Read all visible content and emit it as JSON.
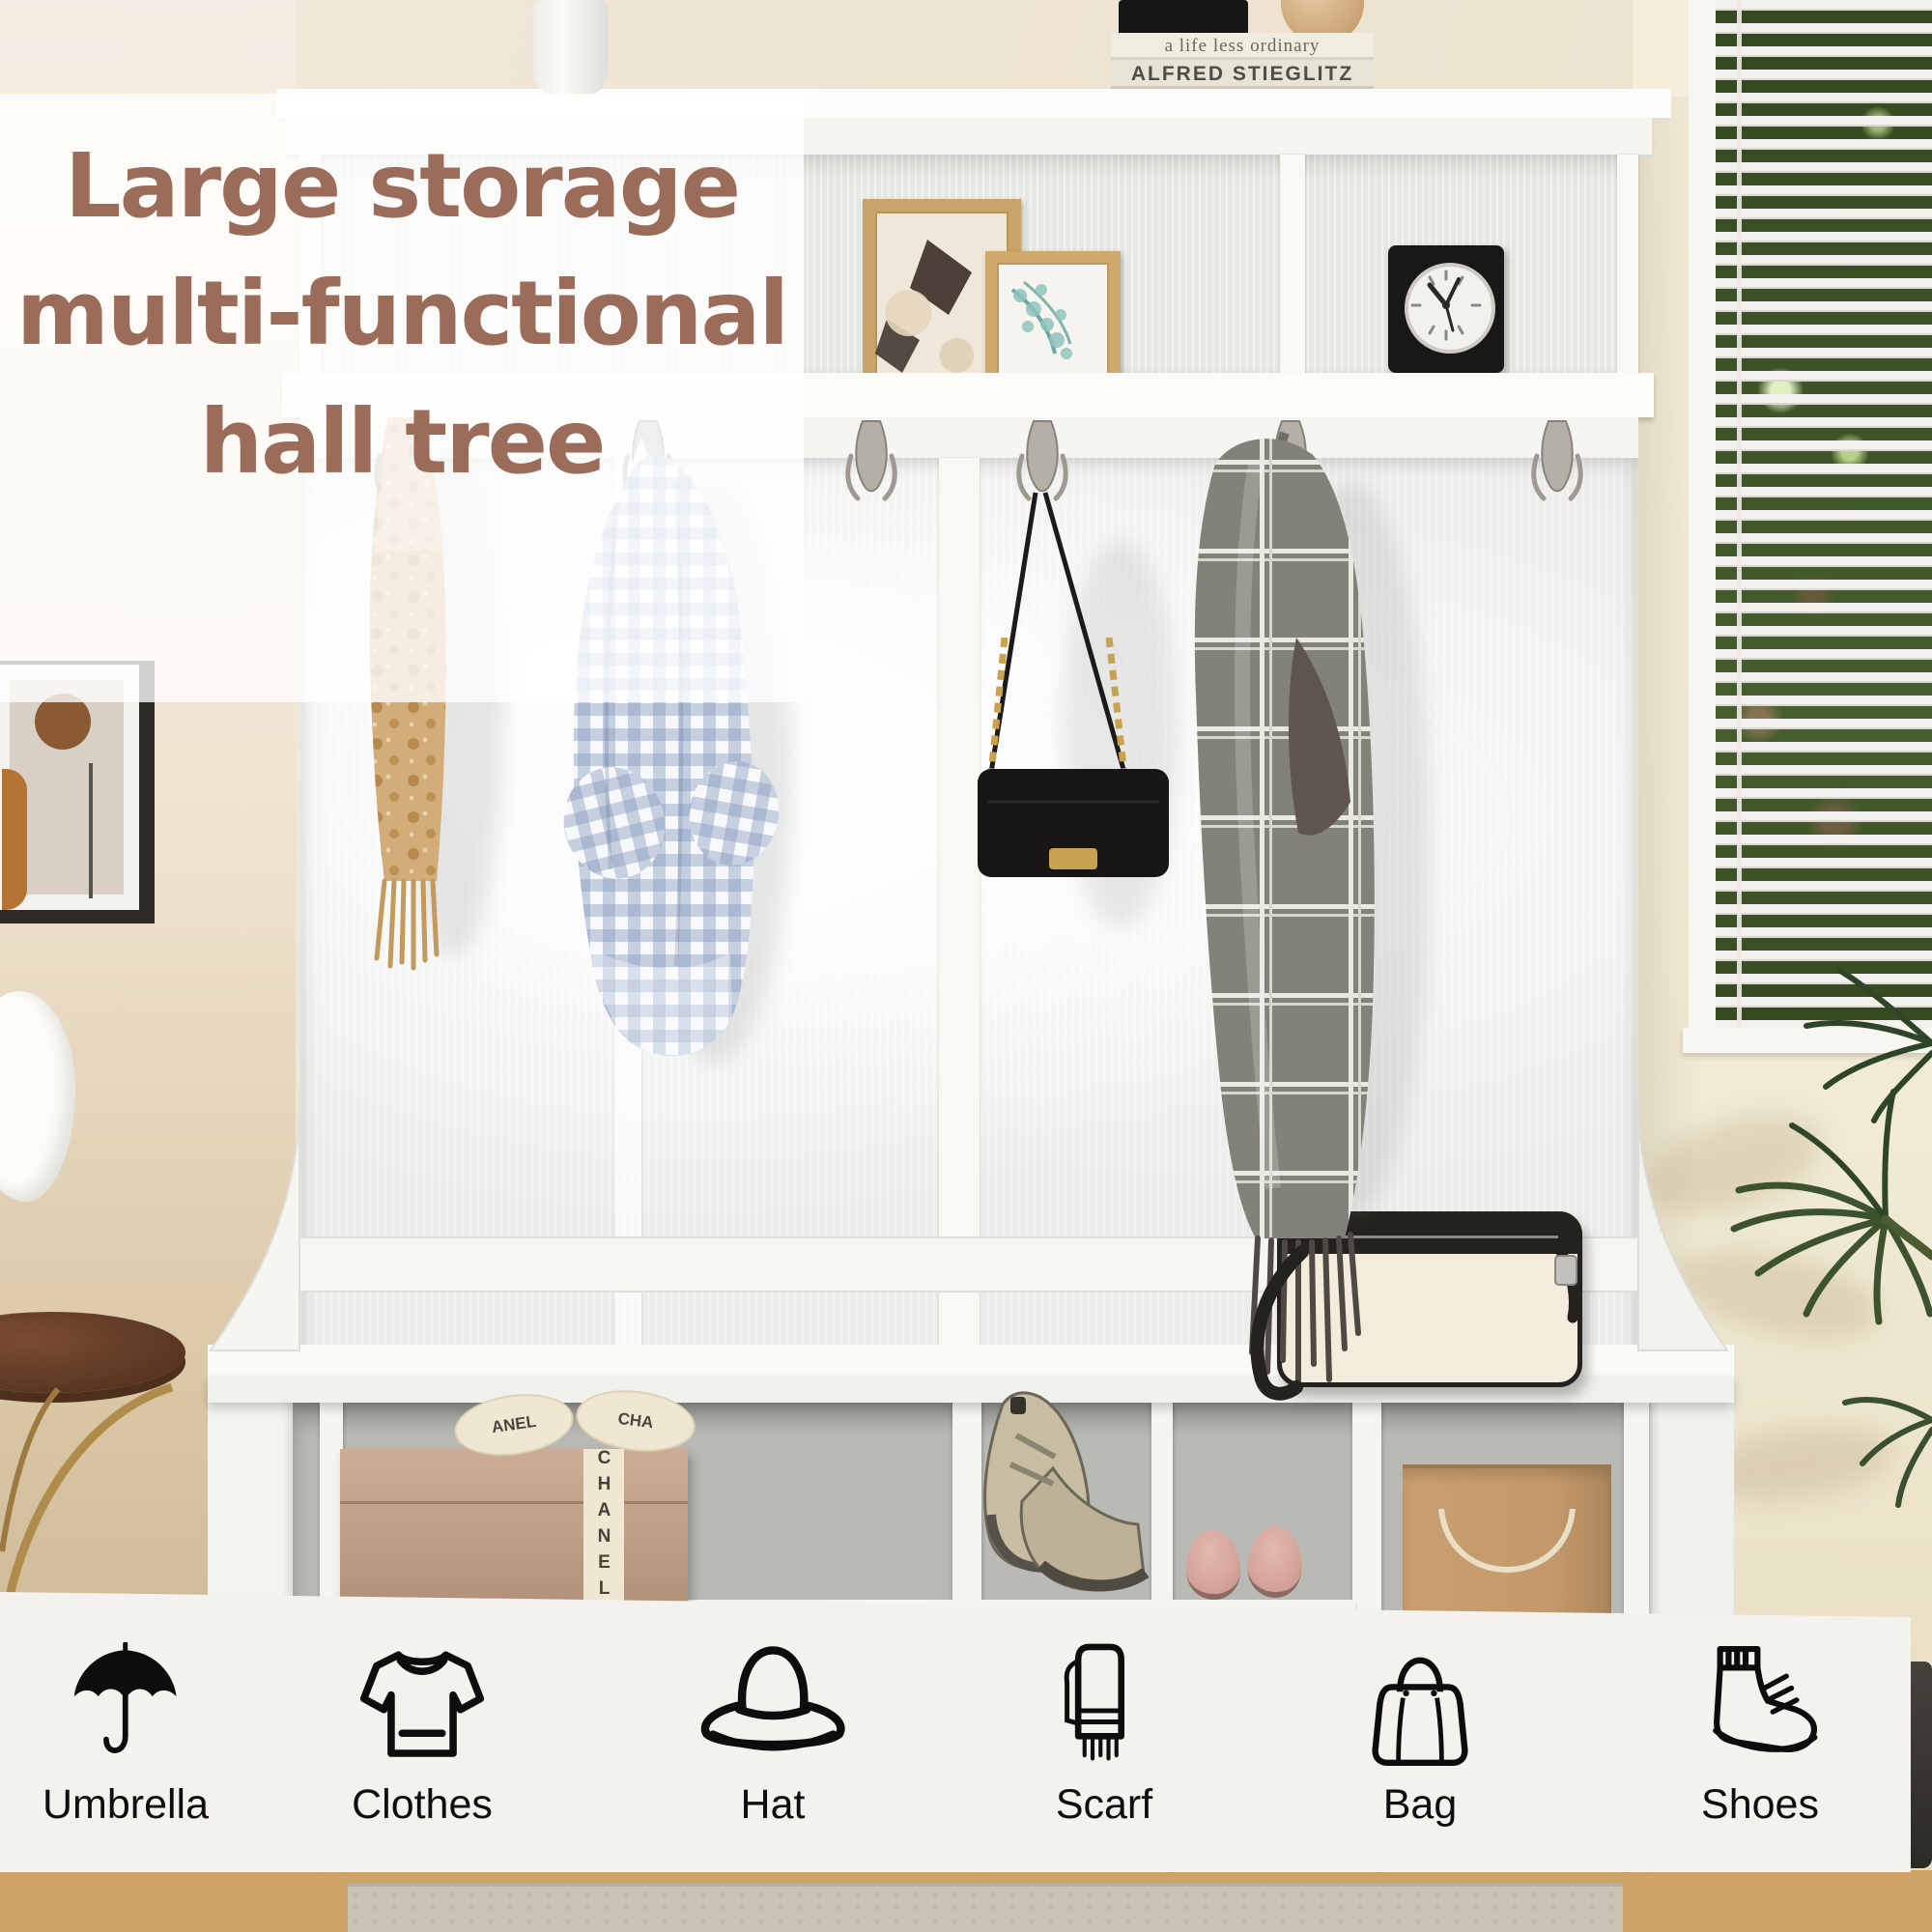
{
  "title": {
    "line1": "Large storage",
    "line2": "multi-functional",
    "line3": "hall tree",
    "color": "#9b6c59"
  },
  "decor": {
    "book_title_top": "a life less ordinary",
    "book_title_bottom": "ALFRED STIEGLITZ",
    "shoebox_ribbon": "CHANEL",
    "shoebox_bow_left": "ANEL",
    "shoebox_bow_right": "CHA"
  },
  "feature_bar": {
    "background": "#f3f2ef",
    "items": [
      {
        "icon": "umbrella-icon",
        "label": "Umbrella"
      },
      {
        "icon": "clothes-icon",
        "label": "Clothes"
      },
      {
        "icon": "hat-icon",
        "label": "Hat"
      },
      {
        "icon": "scarf-icon",
        "label": "Scarf"
      },
      {
        "icon": "bag-icon",
        "label": "Bag"
      },
      {
        "icon": "shoes-icon",
        "label": "Shoes"
      }
    ]
  },
  "colors": {
    "title_brown": "#9b6c59",
    "furniture_white": "#fafaf8",
    "wall_left_beige": "#e9dcc4",
    "wall_right_cream": "#f2ecd8",
    "foliage_green": "#3d5330",
    "floor_wood": "#cda267",
    "icon_black": "#0e0e0e"
  }
}
